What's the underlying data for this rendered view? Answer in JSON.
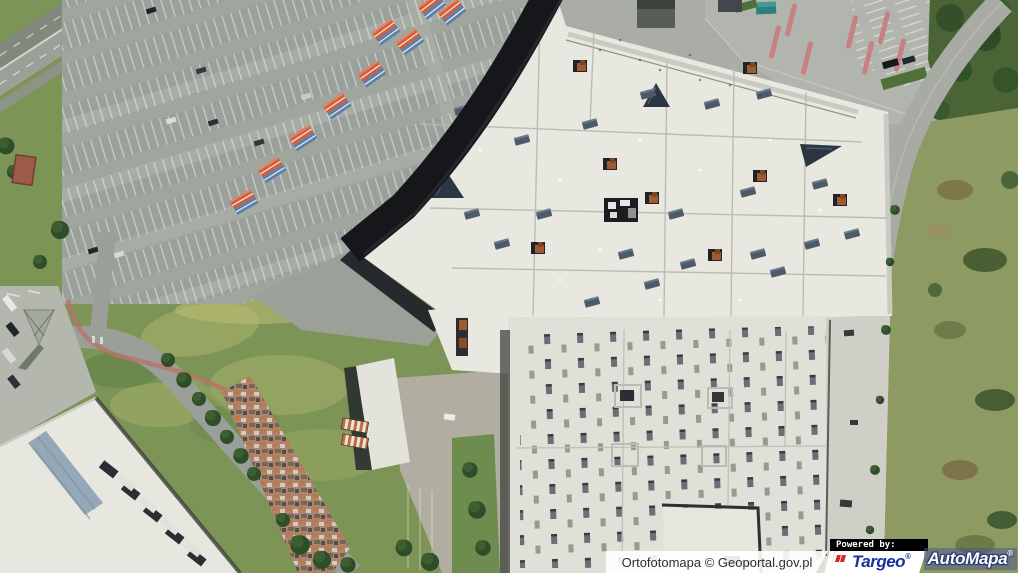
{
  "attribution": {
    "source_label": "Ortofotomapa © Geoportal.gov.pl",
    "powered_by_label": "Powered by:",
    "targeo": {
      "label": "Targeo",
      "reg_mark": "®"
    },
    "automapa": {
      "label": "AutoMapa",
      "reg_mark": "®"
    }
  },
  "brand_colors": {
    "targeo_blue": "#1b2f9e",
    "targeo_red": "#d6281e",
    "automapa_overlay_navy": "#4a5490",
    "attribution_text": "#2e2e2e",
    "powered_by_bg": "#000000"
  }
}
